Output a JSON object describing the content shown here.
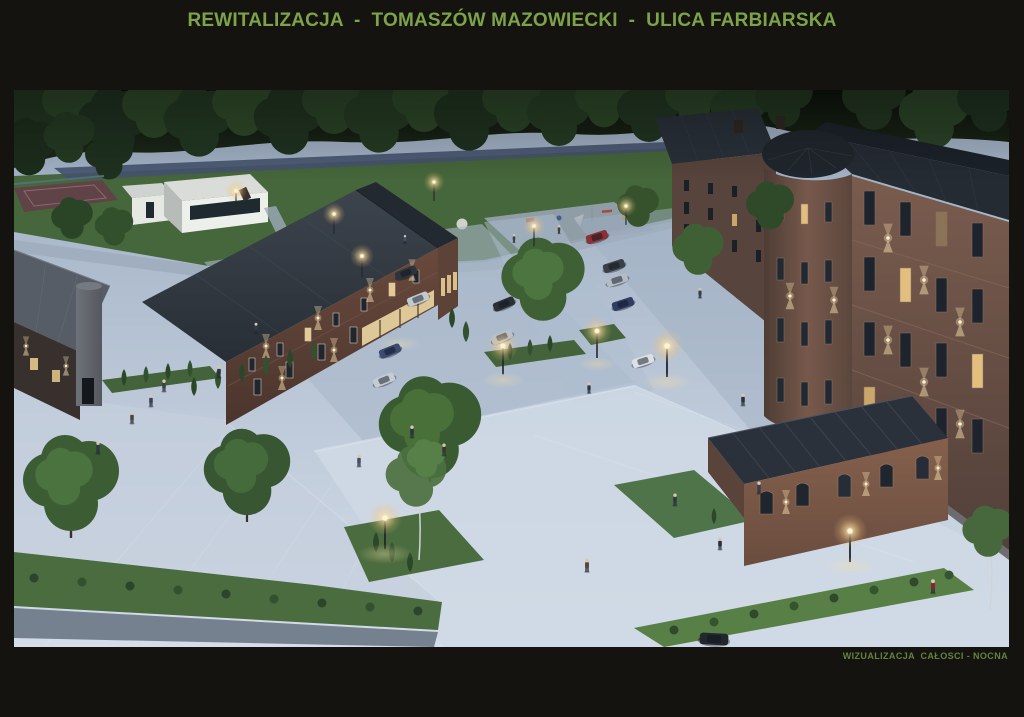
{
  "board": {
    "title": "REWITALIZACJA  -  TOMASZÓW MAZOWIECKI  -  ULICA FARBIARSKA",
    "caption": "WIZUALIZACJA  CAŁOSCI - NOCNA"
  },
  "colors": {
    "background": "#141310",
    "title_green": "#7da348",
    "caption_green": "#66813f",
    "pavement": "#bfcbdb",
    "grass": "#46663b",
    "forest": "#1a2517",
    "brick": "#6e564d",
    "roof_slate": "#262c33",
    "lamp_glow": "#f3cf8e",
    "window_light": "#e8cb8e"
  },
  "scene": {
    "subject": "Night aerial visualization of the revitalized Farbiarska street: brick factory buildings with facade up-lights, park with playground and sports court, tree-lined parking with cars, glowing street lamps and pedestrians on a paved plaza"
  }
}
